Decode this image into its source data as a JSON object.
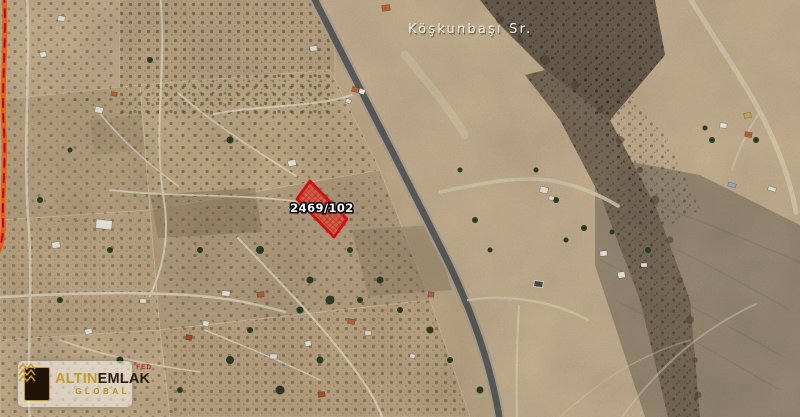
{
  "map": {
    "street_label": "Köşkunbaşı Sr.",
    "parcel_label": "2469/102"
  },
  "logo": {
    "brand_primary": "ALTIN",
    "brand_secondary": "EMLAK",
    "badge": "FED",
    "subtitle": "GLOBAL"
  },
  "colors": {
    "parcel_outline": "#d01010",
    "parcel_fill": "rgba(225,35,25,0.40)",
    "highlight_road": "#ef5a17",
    "logo_gold": "#c79a2a",
    "logo_dark": "#2a1708",
    "logo_red": "#c0181c"
  }
}
